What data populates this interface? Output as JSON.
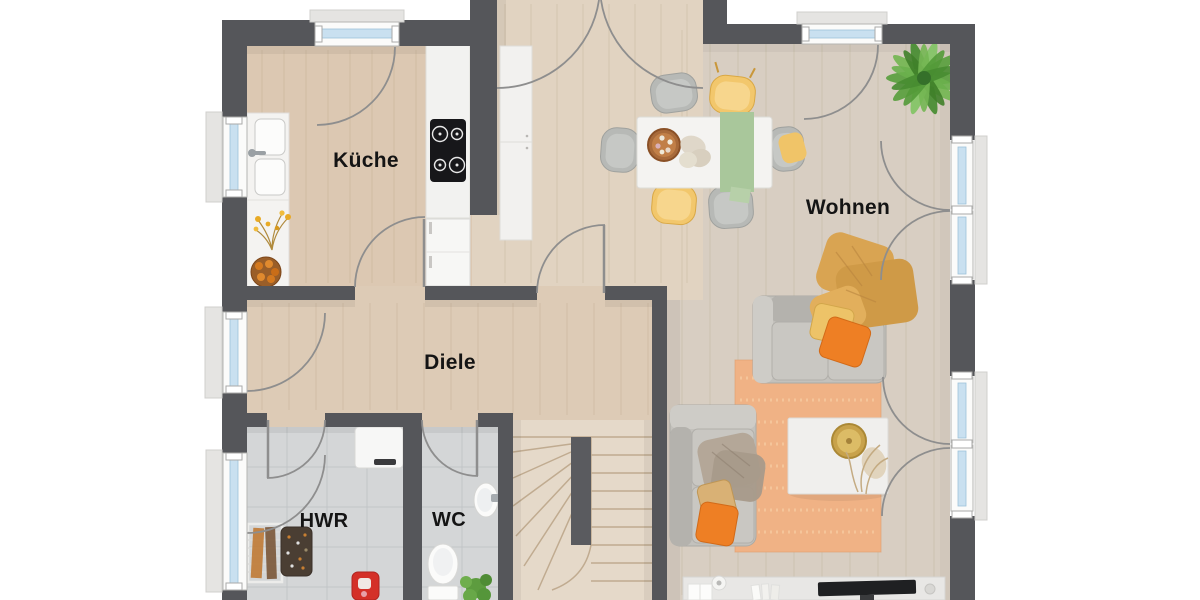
{
  "plan": {
    "type": "floor-plan",
    "floor_texts": []
  },
  "rooms": [
    {
      "id": "kueche",
      "label": "Küche"
    },
    {
      "id": "wohnen",
      "label": "Wohnen"
    },
    {
      "id": "diele",
      "label": "Diele"
    },
    {
      "id": "hwr",
      "label": "HWR"
    },
    {
      "id": "wc",
      "label": "WC"
    }
  ],
  "palette": {
    "wall": "#55565a",
    "wood_kitchen": "#dcc8b2",
    "wood_hall": "#ddcbb6",
    "wood_vestibule": "#e1d3c1",
    "wood_living": "#d8cec2",
    "stairs_wood": "#e5d9c9",
    "tile": "#d4d6d7",
    "window_glass": "#c9e0f0",
    "window_frame": "#fbfbfa",
    "door_arc": "#8e8e8e",
    "rug": "#f0b285",
    "sofa_gray": "#c3c1bc",
    "accent_orange": "#ee7f24",
    "accent_yellow": "#edc368",
    "accent_mustard": "#d9a452",
    "accent_green_runner": "#a9c79b",
    "plant_green": "#5aa03f",
    "background": "#ffffff"
  }
}
